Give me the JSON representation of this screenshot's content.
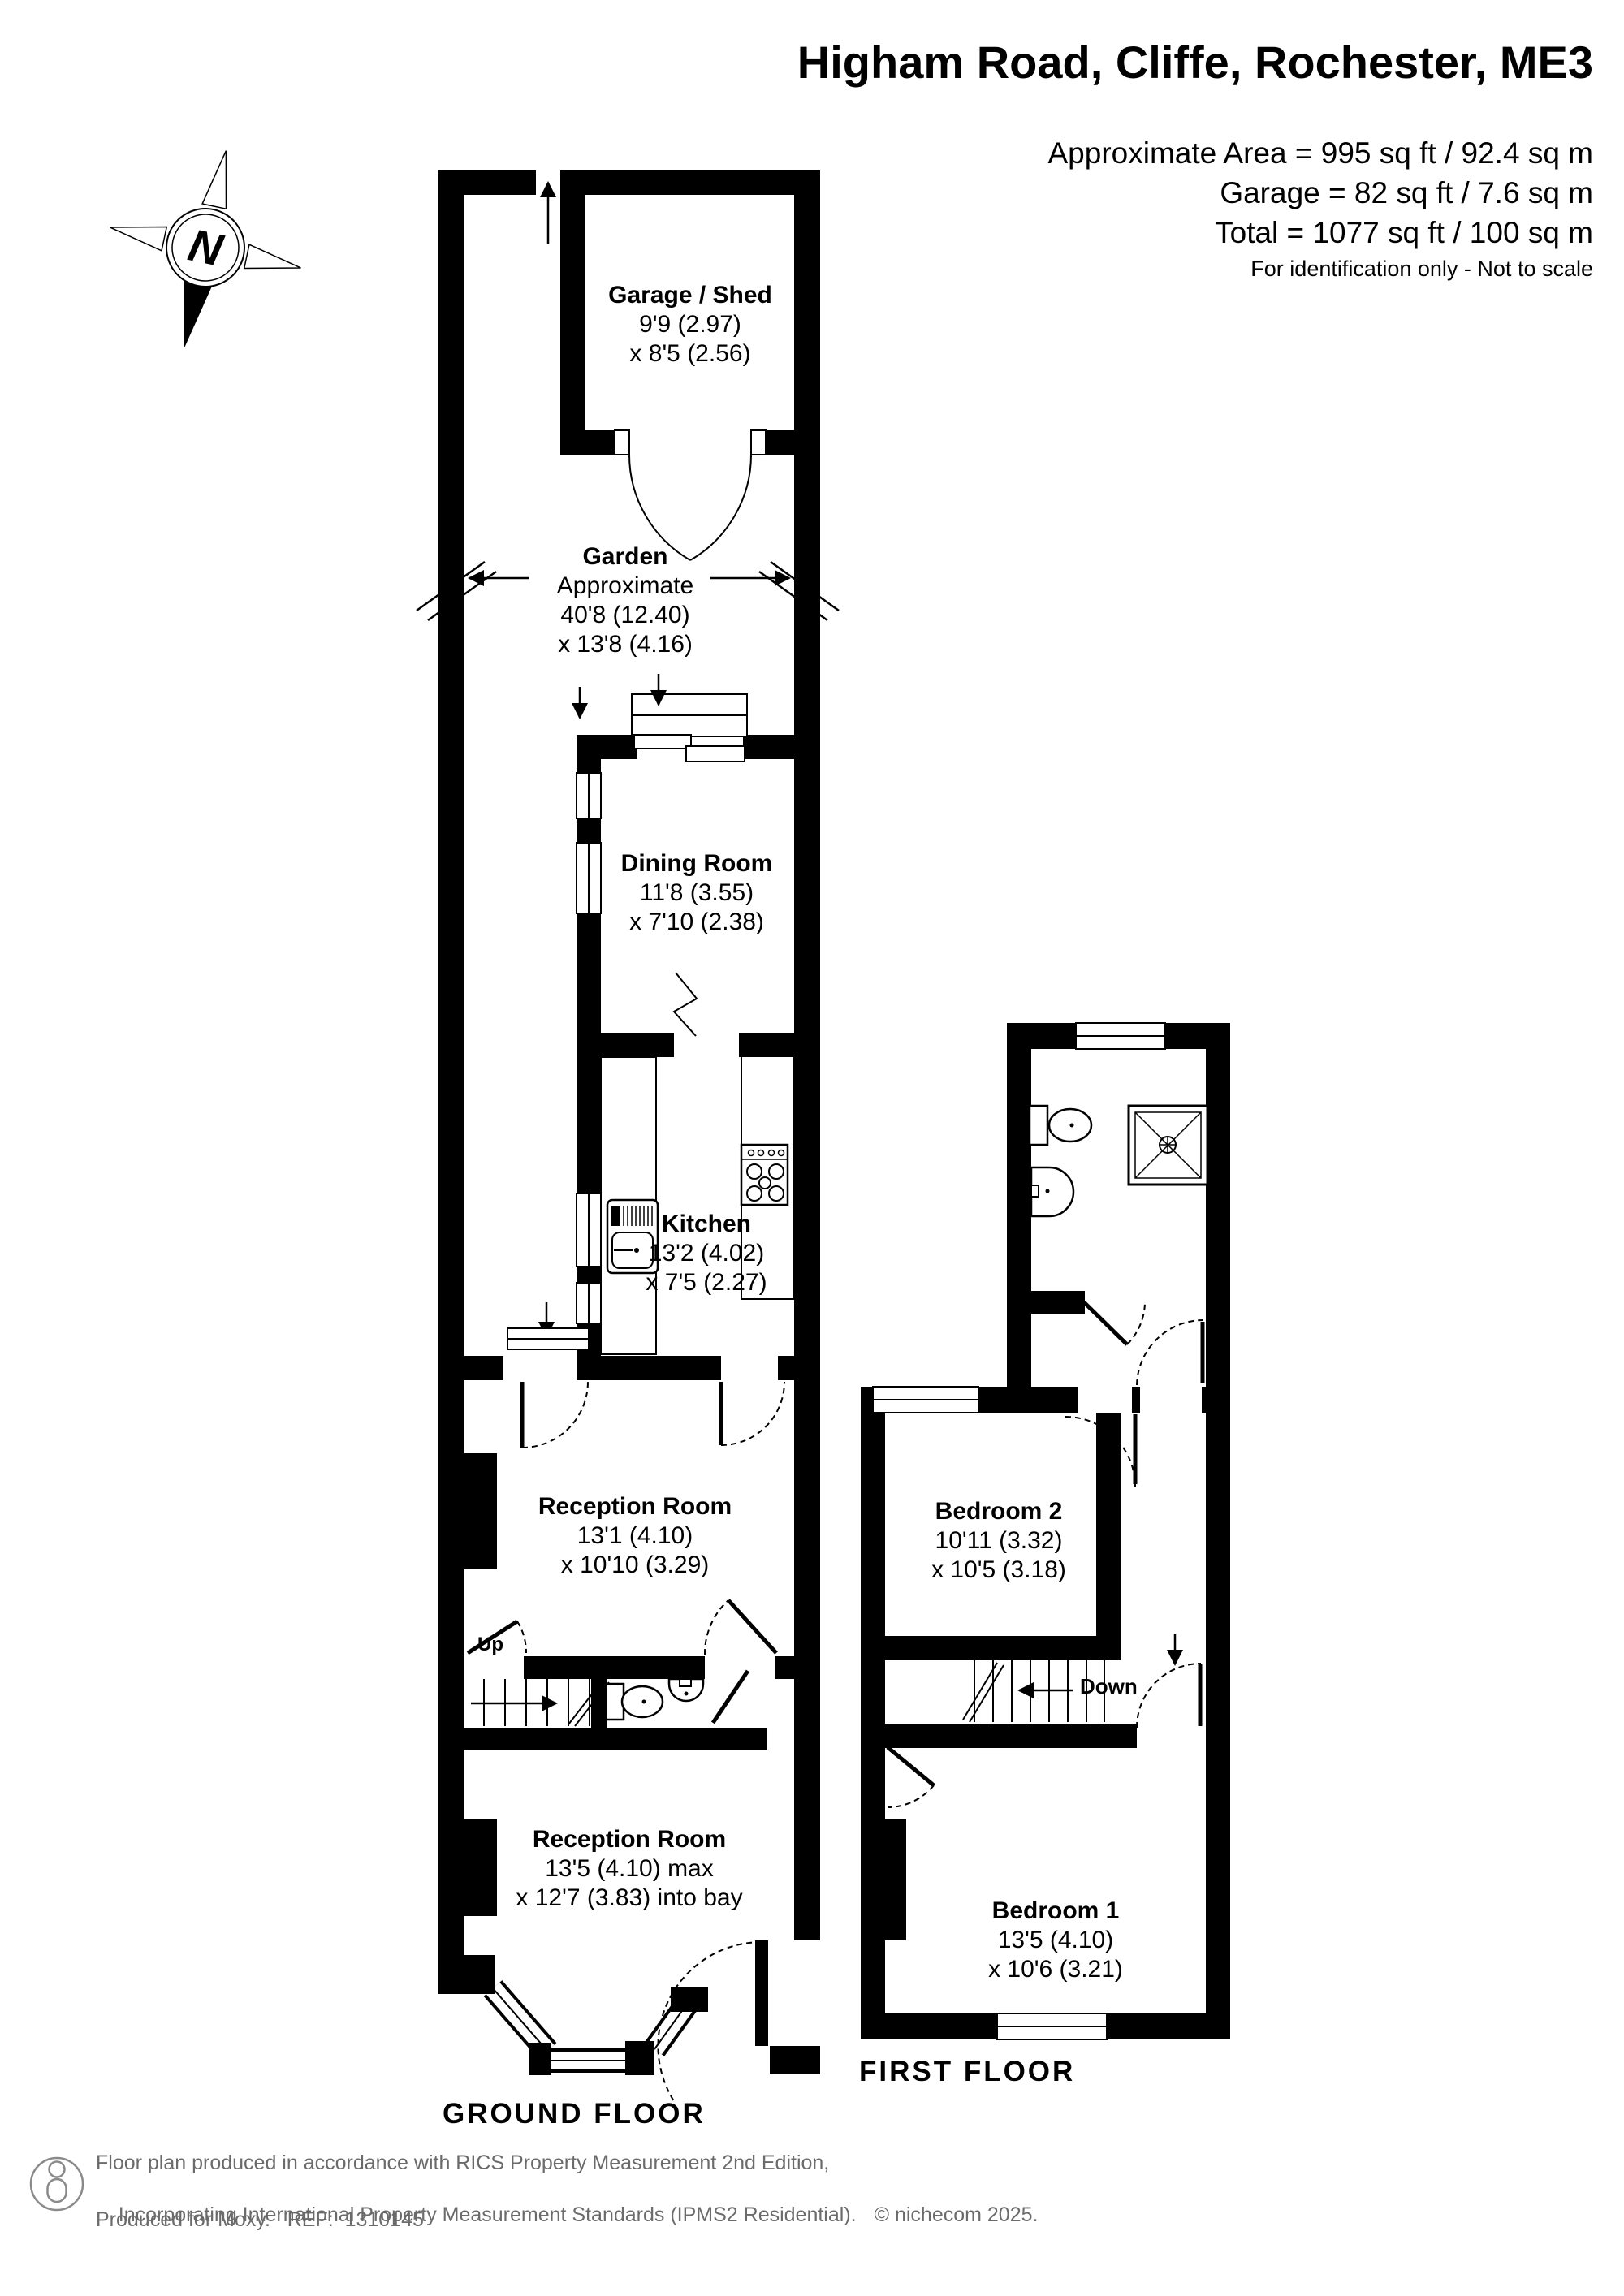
{
  "header": {
    "title": "Higham Road, Cliffe, Rochester, ME3",
    "area_line1": "Approximate Area = 995 sq ft / 92.4 sq m",
    "area_line2": "Garage = 82 sq ft / 7.6 sq m",
    "area_line3": "Total = 1077 sq ft / 100 sq m",
    "disclaimer": "For identification only - Not to scale"
  },
  "compass": {
    "letter": "N"
  },
  "ground_floor": {
    "label": "GROUND FLOOR",
    "stairs_label": "Up",
    "rooms": {
      "garage": {
        "name": "Garage / Shed",
        "dim1": "9'9 (2.97)",
        "dim2": "x 8'5 (2.56)"
      },
      "garden": {
        "name": "Garden",
        "line1": "Approximate",
        "dim1": "40'8 (12.40)",
        "dim2": "x 13'8 (4.16)"
      },
      "dining_room": {
        "name": "Dining Room",
        "dim1": "11'8 (3.55)",
        "dim2": "x 7'10 (2.38)"
      },
      "kitchen": {
        "name": "Kitchen",
        "dim1": "13'2 (4.02)",
        "dim2": "x 7'5 (2.27)"
      },
      "reception_room_1": {
        "name": "Reception Room",
        "dim1": "13'1 (4.10)",
        "dim2": "x 10'10 (3.29)"
      },
      "reception_room_2": {
        "name": "Reception Room",
        "dim1": "13'5 (4.10) max",
        "dim2": "x 12'7 (3.83) into bay"
      }
    }
  },
  "first_floor": {
    "label": "FIRST FLOOR",
    "stairs_label": "Down",
    "rooms": {
      "bedroom_2": {
        "name": "Bedroom 2",
        "dim1": "10'11 (3.32)",
        "dim2": "x 10'5 (3.18)"
      },
      "bedroom_1": {
        "name": "Bedroom 1",
        "dim1": "13'5 (4.10)",
        "dim2": "x 10'6 (3.21)"
      }
    }
  },
  "footer": {
    "line1": "Floor plan produced in accordance with RICS Property Measurement 2nd Edition,",
    "line2": "Incorporating International Property Measurement Standards (IPMS2 Residential).",
    "copyright": "© nichecom 2025.",
    "line3": "Produced for Moxy.   REF:  1310145"
  }
}
